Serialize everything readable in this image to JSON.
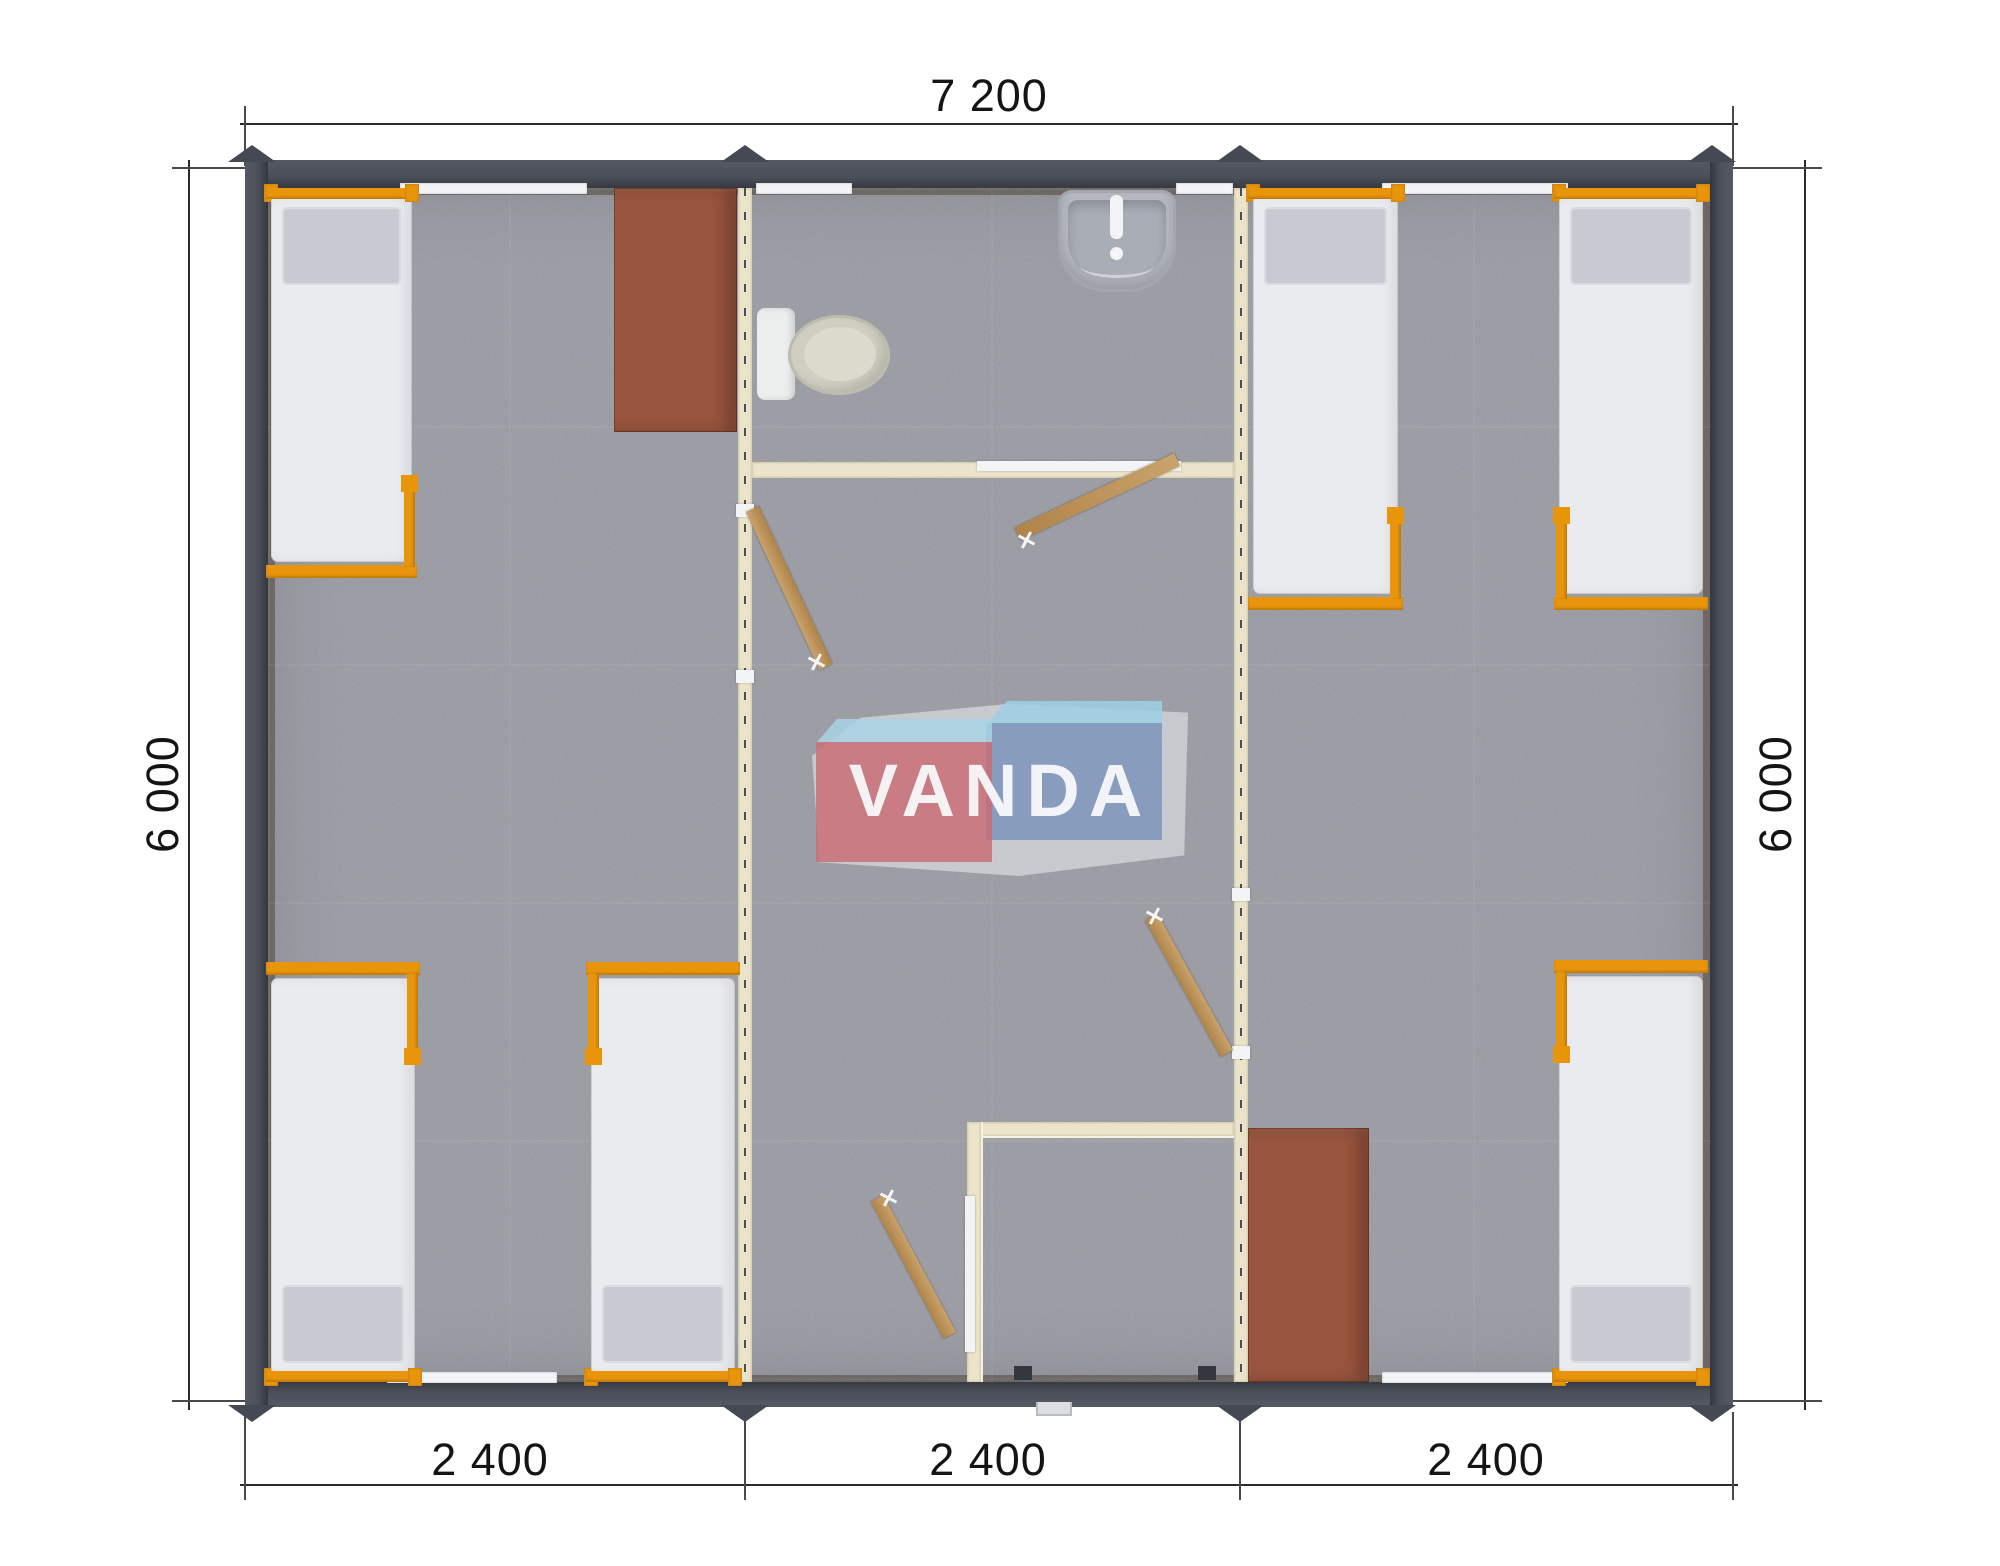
{
  "dimensions": {
    "top_width": "7 200",
    "left_height": "6 000",
    "right_height": "6 000",
    "bottom_segments": [
      "2 400",
      "2 400",
      "2 400"
    ]
  },
  "watermark": {
    "text": "VANDA"
  },
  "colors": {
    "wall": "#4b4f59",
    "floor": "#a0a1a8",
    "partition": "#ebe4cb",
    "bed_frame": "#e8950c",
    "mattress": "#e9ebef",
    "pillow": "#c7cad0",
    "wardrobe": "#9a553e",
    "door": "#c9a26c",
    "dimension_text": "#141414",
    "logo_pink": "#c96f77",
    "logo_blue": "#7d94bb",
    "logo_light_blue": "#9dcfe4"
  },
  "objects": {
    "beds": 6,
    "wardrobes": 2,
    "bathroom_fixtures": [
      "toilet",
      "washbasin"
    ],
    "open_doors": 4,
    "windows": 6
  }
}
